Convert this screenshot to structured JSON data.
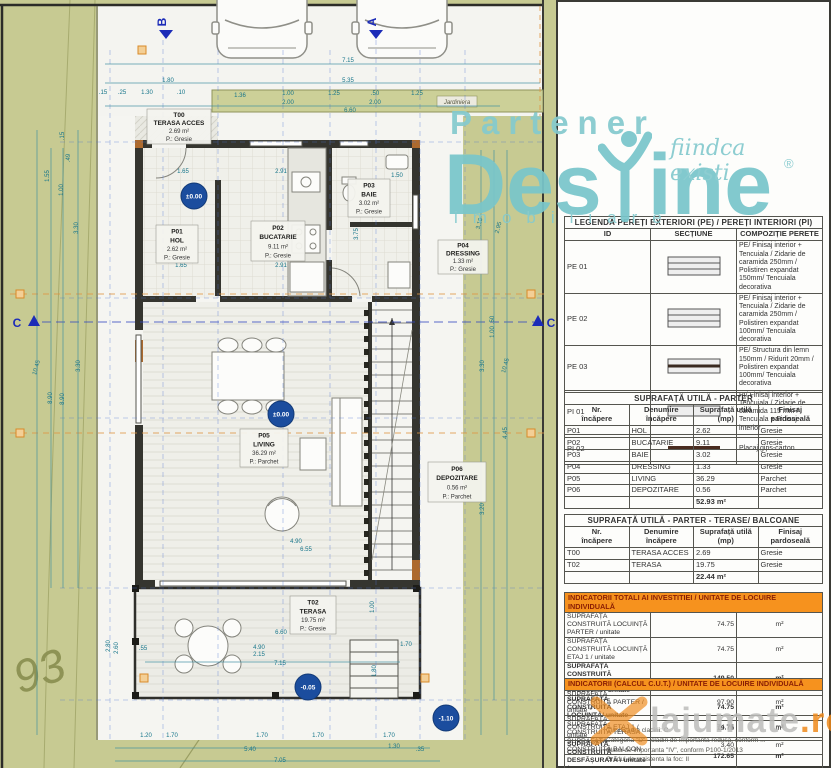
{
  "watermarks": {
    "partener": "Partener",
    "brand_left": "Des",
    "brand_right": "ine",
    "tagline": "fiindca existi",
    "registered": "®",
    "subtitle": "imobiliare",
    "site": "lajumate",
    "site_tld": ".ro",
    "colors": {
      "teal": "#79c6cb",
      "orange": "#ef8b1c",
      "gray": "#bdbdbb"
    }
  },
  "legend": {
    "title": "LEGENDĂ PEREȚI EXTERIORI (PE) / PEREȚI INTERIORI (PI)",
    "col_id": "ID",
    "col_sec": "SECȚIUNE",
    "col_comp": "COMPOZIȚIE PERETE",
    "rows": [
      {
        "id": "PE 01",
        "section": "layers3",
        "comp": "PE/ Finisaj interior + Tencuiala / Zidarie de caramida 250mm / Polistiren expandat 150mm/ Tencuiala decorativa"
      },
      {
        "id": "PE 02",
        "section": "layers3",
        "comp": "PE/ Finisaj interior + Tencuiala / Zidarie de caramida 250mm / Polistiren expandat 100mm/ Tencuiala decorativa"
      },
      {
        "id": "PE 03",
        "section": "wood",
        "comp": "PE/ Structura din lemn 150mm / Ridurit 20mm / Polistiren expandat 100mm/ Tencuiala decorativa"
      },
      {
        "id": "PI 01",
        "section": "plain",
        "comp": "PI/ Finisaj interior + Tencuiala / Zidarie de caramida 115 mm / Tencuiala + Finisaj interior"
      },
      {
        "id": "PI 02",
        "section": "gips",
        "comp": "Placaj gips-carton"
      }
    ]
  },
  "parter_table": {
    "title": "SUPRAFAȚĂ UTILĂ - PARTER",
    "h_nr": "Nr.\nîncăpere",
    "h_name": "Denumire încăpere",
    "h_area": "Suprafață utilă\n(mp)",
    "h_fin": "Finisaj\npardoseală",
    "rows": [
      {
        "nr": "P01",
        "name": "HOL",
        "area": "2.62",
        "fin": "Gresie"
      },
      {
        "nr": "P02",
        "name": "BUCATARIE",
        "area": "9.11",
        "fin": "Gresie"
      },
      {
        "nr": "P03",
        "name": "BAIE",
        "area": "3.02",
        "fin": "Gresie"
      },
      {
        "nr": "P04",
        "name": "DRESSING",
        "area": "1.33",
        "fin": "Gresie"
      },
      {
        "nr": "P05",
        "name": "LIVING",
        "area": "36.29",
        "fin": "Parchet"
      },
      {
        "nr": "P06",
        "name": "DEPOZITARE",
        "area": "0.56",
        "fin": "Parchet"
      }
    ],
    "total": "52.93 m²"
  },
  "terase_table": {
    "title": "SUPRAFAȚĂ UTILĂ - PARTER - TERASE/ BALCOANE",
    "h_nr": "Nr.\nîncăpere",
    "h_name": "Denumire încăpere",
    "h_area": "Suprafață utilă\n(mp)",
    "h_fin": "Finisaj\npardoseală",
    "rows": [
      {
        "nr": "T00",
        "name": "TERASA ACCES",
        "area": "2.69",
        "fin": "Gresie"
      },
      {
        "nr": "T02",
        "name": "TERASA",
        "area": "19.75",
        "fin": "Gresie"
      }
    ],
    "total": "22.44 m²"
  },
  "indicators_investitie": {
    "title": "INDICATORII TOTALI AI INVESTITIEI / UNITATE DE LOCUIRE INDIVIDUALĂ",
    "rows": [
      {
        "label": "SUPRAFAȚĂ CONSTRUITĂ LOCUINȚĂ PARTER / unitate",
        "value": "74.75",
        "unit": "m²",
        "bold": false
      },
      {
        "label": "SUPRAFAȚĂ CONSTRUITĂ LOCUINȚĂ ETAJ 1 / unitate",
        "value": "74.75",
        "unit": "m²",
        "bold": false
      },
      {
        "label": "SUPRAFAȚĂ CONSTRUITĂ DESFĂȘURATĂ LOCUINȚĂ / unitate",
        "value": "149.50",
        "unit": "m²",
        "bold": true
      },
      {
        "label": "SUPRAFAȚĂ CONSTRUITĂ LOCUINȚĂ/ unitate",
        "value": "74.75",
        "unit": "m²",
        "bold": true
      },
      {
        "label": "SUPRAFAȚĂ CONSTRUITĂ TERASĂ",
        "value": "19.75",
        "unit": "m²",
        "bold": false
      },
      {
        "label": "SUPRAFAȚĂ CONSTRUITĂ BALCON",
        "value": "3.40",
        "unit": "m²",
        "bold": false
      }
    ]
  },
  "indicators_cut": {
    "title": "INDICATORII (CALCUL C.U.T.) / UNITATE DE LOCUIRE INDIVIDUALĂ",
    "rows": [
      {
        "label": "SUPRAFAȚĂ CONSTRUITĂ PARTER / unitate *",
        "value": "97.90",
        "unit": "m²",
        "bold": false
      },
      {
        "label": "SUPRAFAȚĂ CONSTRUITĂ ETAJ 1 / unitate",
        "value": "74.75",
        "unit": "m²",
        "bold": false
      },
      {
        "label": "SUPRAFAȚĂ CONSTRUITĂ DESFĂȘURATĂ / unitate *",
        "value": "172.65",
        "unit": "m²",
        "bold": true
      },
      {
        "label": "SUPRAFAȚĂ CONSTRUITĂ / unitate *",
        "value": "97.90",
        "unit": "m²",
        "bold": true
      }
    ]
  },
  "notes": {
    "lines": [
      "Clasificarea cladirii: C",
      "Categoria \"D\" - cladiri de importanta redusa, conform ...",
      "Clasa de importanta \"IV\", conform P100-1/2013",
      "Gradul de rezistenta la foc: II"
    ]
  },
  "plan": {
    "jardiniera": "Jardiniera",
    "contour_label": "93",
    "rooms": [
      {
        "x": 147,
        "y": 109,
        "w": 64,
        "h": 35,
        "id": "T00",
        "name": "TERASA ACCES",
        "area": "2.69 m²",
        "fin": "P.: Gresie"
      },
      {
        "x": 156,
        "y": 225,
        "w": 42,
        "h": 38,
        "id": "P01",
        "name": "HOL",
        "area": "2.62 m²",
        "fin": "P.: Gresie"
      },
      {
        "x": 251,
        "y": 221,
        "w": 54,
        "h": 40,
        "id": "P02",
        "name": "BUCATARIE",
        "area": "9.11 m²",
        "fin": "P.: Gresie"
      },
      {
        "x": 348,
        "y": 179,
        "w": 42,
        "h": 38,
        "id": "P03",
        "name": "BAIE",
        "area": "3.02 m²",
        "fin": "P.: Gresie"
      },
      {
        "x": 438,
        "y": 240,
        "w": 50,
        "h": 34,
        "id": "P04",
        "name": "DRESSING",
        "area": "1.33 m²",
        "fin": "P.: Gresie"
      },
      {
        "x": 240,
        "y": 429,
        "w": 48,
        "h": 38,
        "id": "P05",
        "name": "LIVING",
        "area": "36.29 m²",
        "fin": "P.: Parchet"
      },
      {
        "x": 428,
        "y": 462,
        "w": 58,
        "h": 40,
        "id": "P06",
        "name": "DEPOZITARE",
        "area": "0.56 m²",
        "fin": "P.: Parchet"
      },
      {
        "x": 290,
        "y": 596,
        "w": 46,
        "h": 38,
        "id": "T02",
        "name": "TERASA",
        "area": "19.75 m²",
        "fin": "P.: Gresie"
      }
    ],
    "levels": [
      {
        "t": "±0.00",
        "x": 194,
        "y": 196
      },
      {
        "t": "±0.00",
        "x": 281,
        "y": 414
      },
      {
        "t": "-0.05",
        "x": 308,
        "y": 687
      },
      {
        "t": "-1.10",
        "x": 446,
        "y": 718
      }
    ],
    "sections": [
      {
        "label": "B",
        "tx": 166,
        "ty": 30,
        "tri": "down",
        "lx": 166,
        "ly": 22,
        "lrot": -90
      },
      {
        "label": "A",
        "tx": 376,
        "ty": 30,
        "tri": "down",
        "lx": 376,
        "ly": 22,
        "lrot": -90
      },
      {
        "label": "C",
        "tx": 34,
        "ty": 322,
        "tri": "up",
        "lx": 17,
        "ly": 327,
        "lrot": 0
      },
      {
        "label": "C",
        "tx": 538,
        "ty": 322,
        "tri": "up",
        "lx": 551,
        "ly": 327,
        "lrot": 0
      }
    ],
    "dims": [
      {
        "t": "7.15",
        "x": 348,
        "y": 62
      },
      {
        "t": "1.80",
        "x": 168,
        "y": 82
      },
      {
        "t": "5.35",
        "x": 348,
        "y": 82
      },
      {
        "t": ".15",
        "x": 103,
        "y": 94
      },
      {
        "t": ".25",
        "x": 122,
        "y": 94
      },
      {
        "t": "1.30",
        "x": 147,
        "y": 94
      },
      {
        "t": ".10",
        "x": 181,
        "y": 94
      },
      {
        "t": "1.36",
        "x": 240,
        "y": 97
      },
      {
        "t": "1.00",
        "x": 288,
        "y": 95
      },
      {
        "t": "2.00",
        "x": 288,
        "y": 104
      },
      {
        "t": "1.25",
        "x": 334,
        "y": 95
      },
      {
        "t": ".50",
        "x": 375,
        "y": 95
      },
      {
        "t": "2.00",
        "x": 375,
        "y": 104
      },
      {
        "t": "1.25",
        "x": 417,
        "y": 95
      },
      {
        "t": "6.60",
        "x": 350,
        "y": 112
      },
      {
        "t": "1.65",
        "x": 183,
        "y": 173
      },
      {
        "t": "2.91",
        "x": 281,
        "y": 173
      },
      {
        "t": "1.50",
        "x": 397,
        "y": 177
      },
      {
        "t": "1.65",
        "x": 181,
        "y": 267
      },
      {
        "t": "2.91",
        "x": 281,
        "y": 267
      },
      {
        "t": "3.75",
        "x": 358,
        "y": 234,
        "r": -90
      },
      {
        "t": ".15",
        "x": 64,
        "y": 136,
        "r": -90
      },
      {
        "t": ".49",
        "x": 70,
        "y": 158,
        "r": -90
      },
      {
        "t": "1.55",
        "x": 49,
        "y": 176,
        "r": -90
      },
      {
        "t": "1.00",
        "x": 63,
        "y": 190,
        "r": -90
      },
      {
        "t": "3.30",
        "x": 78,
        "y": 228,
        "r": -90
      },
      {
        "t": "10.45",
        "x": 38,
        "y": 368,
        "r": -75
      },
      {
        "t": "8.90",
        "x": 52,
        "y": 398,
        "r": -90
      },
      {
        "t": "8.90",
        "x": 64,
        "y": 399,
        "r": -90
      },
      {
        "t": "3.30",
        "x": 80,
        "y": 366,
        "r": -90
      },
      {
        "t": "2.80",
        "x": 110,
        "y": 646,
        "r": -90
      },
      {
        "t": "2.60",
        "x": 118,
        "y": 648,
        "r": -90
      },
      {
        "t": "3.10",
        "x": 481,
        "y": 224,
        "r": -75
      },
      {
        "t": "2.95",
        "x": 500,
        "y": 228,
        "r": -75
      },
      {
        "t": ".50",
        "x": 494,
        "y": 320,
        "r": -90
      },
      {
        "t": "1.00",
        "x": 494,
        "y": 332,
        "r": -90
      },
      {
        "t": "3.30",
        "x": 484,
        "y": 366,
        "r": -90
      },
      {
        "t": "10.45",
        "x": 507,
        "y": 366,
        "r": -75
      },
      {
        "t": "4.45",
        "x": 507,
        "y": 433,
        "r": -90
      },
      {
        "t": "3.20",
        "x": 484,
        "y": 509,
        "r": -90
      },
      {
        "t": "1.00",
        "x": 374,
        "y": 607,
        "r": -90
      },
      {
        "t": "1.70",
        "x": 406,
        "y": 646
      },
      {
        "t": "1.80",
        "x": 376,
        "y": 671,
        "r": -90
      },
      {
        "t": "4.90",
        "x": 296,
        "y": 543
      },
      {
        "t": "6.55",
        "x": 306,
        "y": 551
      },
      {
        "t": "6.60",
        "x": 281,
        "y": 634
      },
      {
        "t": "4.90",
        "x": 259,
        "y": 649
      },
      {
        "t": "2.15",
        "x": 259,
        "y": 656
      },
      {
        "t": "7.15",
        "x": 280,
        "y": 665
      },
      {
        "t": ".55",
        "x": 143,
        "y": 650
      },
      {
        "t": "1.20",
        "x": 146,
        "y": 737
      },
      {
        "t": "1.70",
        "x": 172,
        "y": 737
      },
      {
        "t": "1.70",
        "x": 262,
        "y": 737
      },
      {
        "t": "1.70",
        "x": 318,
        "y": 737
      },
      {
        "t": "1.70",
        "x": 389,
        "y": 737
      },
      {
        "t": "5.40",
        "x": 250,
        "y": 751
      },
      {
        "t": "1.30",
        "x": 394,
        "y": 748
      },
      {
        "t": ".35",
        "x": 420,
        "y": 751
      },
      {
        "t": "7.05",
        "x": 280,
        "y": 762
      }
    ]
  }
}
